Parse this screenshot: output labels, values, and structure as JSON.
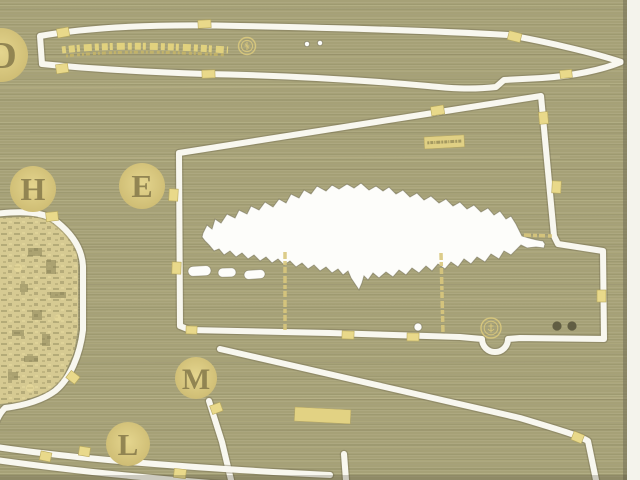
{
  "part_labels": {
    "d": "D",
    "h": "H",
    "e": "E",
    "m": "M",
    "l": "L"
  },
  "icons": {
    "maker_mark_d": "circular-maker-emblem",
    "maker_mark_e": "circular-maker-emblem"
  },
  "colors": {
    "brass": "#a6a177",
    "brass_light": "#c6c092",
    "brass_dark": "#8d885f",
    "etch_gold": "#d8c77d",
    "tab_gold": "#e9d98a",
    "letter": "#85794a",
    "cut_white": "#f8f7ef",
    "backing_white": "#fdfdfa",
    "rim_dark": "#706c52",
    "fold_gold": "#d8c77c"
  }
}
